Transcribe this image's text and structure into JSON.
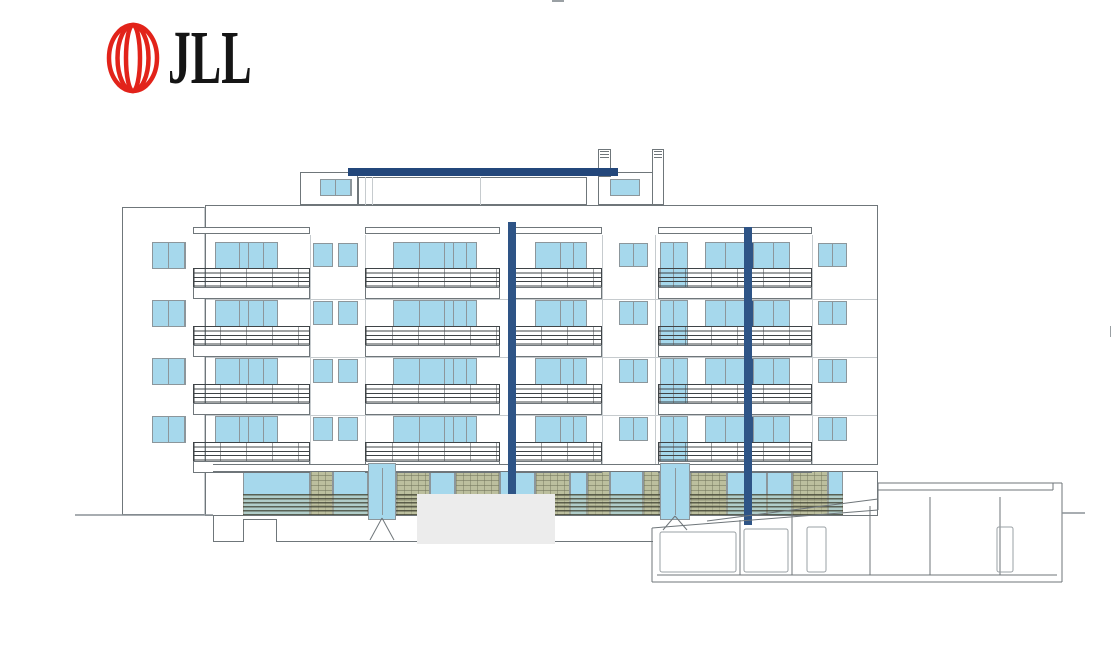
{
  "page": {
    "width": 1116,
    "height": 655,
    "background": "#ffffff"
  },
  "logo": {
    "mark_icon": "jll-sphere-mark",
    "text": "JLL",
    "red": "#E2231A",
    "text_color": "#151515"
  },
  "colors": {
    "glass": "#A6D8EC",
    "frame": "#8C969B",
    "navy": "#2E5486",
    "beam": "#23477B",
    "line": "#6F767A",
    "faint": "#C6CBCE",
    "olive": "#BCBF9E",
    "olive_dark": "#70735A",
    "rail": "#3F4447",
    "redact": "#ECECEC",
    "white": "#FFFFFF"
  },
  "elevation": {
    "floor_tops": [
      242,
      300,
      358,
      416
    ],
    "window_h": 27,
    "facade": {
      "x": 205,
      "y": 205,
      "w": 673,
      "h": 311
    },
    "left_wall": {
      "x": 122,
      "y": 207,
      "w": 83,
      "h": 308
    },
    "window_groups": [
      {
        "name": "side-window",
        "x": 152,
        "w": 34,
        "panes": [
          15,
          15
        ]
      },
      {
        "name": "balcony-door-a",
        "x": 215,
        "w": 63,
        "panes": [
          23,
          8,
          14,
          14
        ]
      },
      {
        "name": "square-window",
        "x": 313,
        "w": 20,
        "dy": 1,
        "h": 24,
        "panes": [
          18
        ]
      },
      {
        "name": "square-window",
        "x": 338,
        "w": 20,
        "dy": 1,
        "h": 24,
        "panes": [
          18
        ]
      },
      {
        "name": "balcony-door-b",
        "x": 393,
        "w": 84,
        "panes": [
          25,
          24,
          8,
          12,
          11
        ]
      },
      {
        "name": "balcony-door-c",
        "x": 535,
        "w": 52,
        "panes": [
          24,
          12,
          12
        ]
      },
      {
        "name": "square-window-wide",
        "x": 619,
        "w": 29,
        "dy": 1,
        "h": 24,
        "panes": [
          13,
          13
        ]
      },
      {
        "name": "tall-window",
        "x": 660,
        "w": 28,
        "h": 48,
        "panes": [
          12,
          13
        ]
      },
      {
        "name": "balcony-door-d",
        "x": 705,
        "w": 85,
        "panes": [
          19,
          18,
          -8,
          19,
          17
        ]
      },
      {
        "name": "square-window-wide",
        "x": 818,
        "w": 29,
        "dy": 1,
        "h": 24,
        "panes": [
          13,
          13
        ]
      }
    ],
    "balcony_bays": [
      [
        193,
        117
      ],
      [
        365,
        135
      ],
      [
        514,
        88
      ],
      [
        658,
        154
      ]
    ],
    "canopies_y": 227,
    "faint_h_lines_y": [
      299,
      357,
      415
    ],
    "faint_v_lines_x": [
      310,
      365,
      602,
      655,
      812
    ],
    "columns": [
      {
        "x": 508,
        "y": 222,
        "w": 8,
        "h": 272
      },
      {
        "x": 744,
        "y": 227,
        "w": 8,
        "h": 298
      }
    ],
    "roof": {
      "beam": {
        "x": 348,
        "y": 168,
        "w": 270,
        "h": 8
      },
      "penthouse_left": {
        "x": 300,
        "y": 172,
        "w": 58,
        "h": 33,
        "window": {
          "x": 320,
          "y": 179,
          "w": 32,
          "h": 17,
          "panes": [
            14,
            14
          ]
        }
      },
      "penthouse_mid": {
        "x": 358,
        "y": 177,
        "w": 229,
        "h": 28,
        "vlines": [
          365,
          372,
          480
        ]
      },
      "penthouse_right": {
        "x": 598,
        "y": 172,
        "w": 62,
        "h": 33,
        "window": {
          "x": 610,
          "y": 179,
          "w": 30,
          "h": 17,
          "panes": [
            28
          ]
        }
      },
      "chimneys": [
        {
          "x": 598,
          "y": 149,
          "w": 13,
          "h": 28
        },
        {
          "x": 652,
          "y": 149,
          "w": 12,
          "h": 56
        }
      ]
    },
    "ground": {
      "slab": {
        "x": 213,
        "y": 464,
        "w": 665,
        "h": 8
      },
      "band": {
        "x": 243,
        "y": 470,
        "w": 600,
        "h": 46
      },
      "cells": [
        [
          243,
          67,
          "g"
        ],
        [
          310,
          23,
          "o"
        ],
        [
          333,
          35,
          "g"
        ],
        [
          396,
          34,
          "o"
        ],
        [
          430,
          25,
          "g"
        ],
        [
          455,
          45,
          "o"
        ],
        [
          500,
          35,
          "g"
        ],
        [
          535,
          35,
          "o"
        ],
        [
          570,
          17,
          "g"
        ],
        [
          587,
          23,
          "o"
        ],
        [
          610,
          33,
          "g"
        ],
        [
          643,
          17,
          "o"
        ],
        [
          690,
          37,
          "o"
        ],
        [
          727,
          40,
          "g"
        ],
        [
          767,
          25,
          "g"
        ],
        [
          792,
          36,
          "o"
        ],
        [
          828,
          15,
          "g"
        ]
      ],
      "louver_overlay": {
        "x": 243,
        "y": 494,
        "w": 600,
        "h": 22
      },
      "entrances": [
        {
          "x": 368,
          "w": 28
        },
        {
          "x": 660,
          "w": 30
        }
      ],
      "entrance_y": 463,
      "entrance_h": 57,
      "basement": {
        "x": 213,
        "y": 516,
        "w": 440,
        "h": 26
      },
      "door": {
        "x": 243,
        "y": 519,
        "w": 34,
        "h": 23
      },
      "redact": {
        "x": 417,
        "y": 494,
        "w": 138,
        "h": 50
      }
    },
    "section": {
      "lines": [
        [
          652,
          528,
          878,
          510
        ],
        [
          707,
          521,
          878,
          499
        ],
        [
          652,
          528,
          652,
          582
        ],
        [
          652,
          582,
          1062,
          582
        ],
        [
          657,
          575,
          1057,
          575
        ],
        [
          1062,
          483,
          1062,
          582
        ],
        [
          878,
          483,
          1062,
          483
        ],
        [
          878,
          490,
          1053,
          490
        ],
        [
          1053,
          483,
          1053,
          490
        ],
        [
          878,
          483,
          878,
          510
        ],
        [
          740,
          520,
          740,
          575
        ],
        [
          792,
          514,
          792,
          575
        ],
        [
          870,
          506,
          870,
          575
        ],
        [
          930,
          497,
          930,
          575
        ],
        [
          1000,
          497,
          1000,
          575
        ]
      ],
      "doors": [
        [
          807,
          527,
          19,
          45
        ],
        [
          997,
          527,
          16,
          45
        ]
      ],
      "cells": [
        [
          660,
          532,
          76,
          40
        ],
        [
          744,
          529,
          44,
          43
        ]
      ],
      "braces": [
        [
          370,
          540,
          382,
          518
        ],
        [
          382,
          518,
          394,
          540
        ],
        [
          663,
          530,
          675,
          516
        ],
        [
          675,
          516,
          687,
          530
        ]
      ],
      "ground_lines": [
        [
          75,
          515,
          213,
          515
        ],
        [
          1062,
          513,
          1085,
          513
        ]
      ],
      "artifacts": [
        [
          552,
          0,
          12,
          2
        ],
        [
          1110,
          326,
          1,
          11
        ]
      ]
    }
  }
}
